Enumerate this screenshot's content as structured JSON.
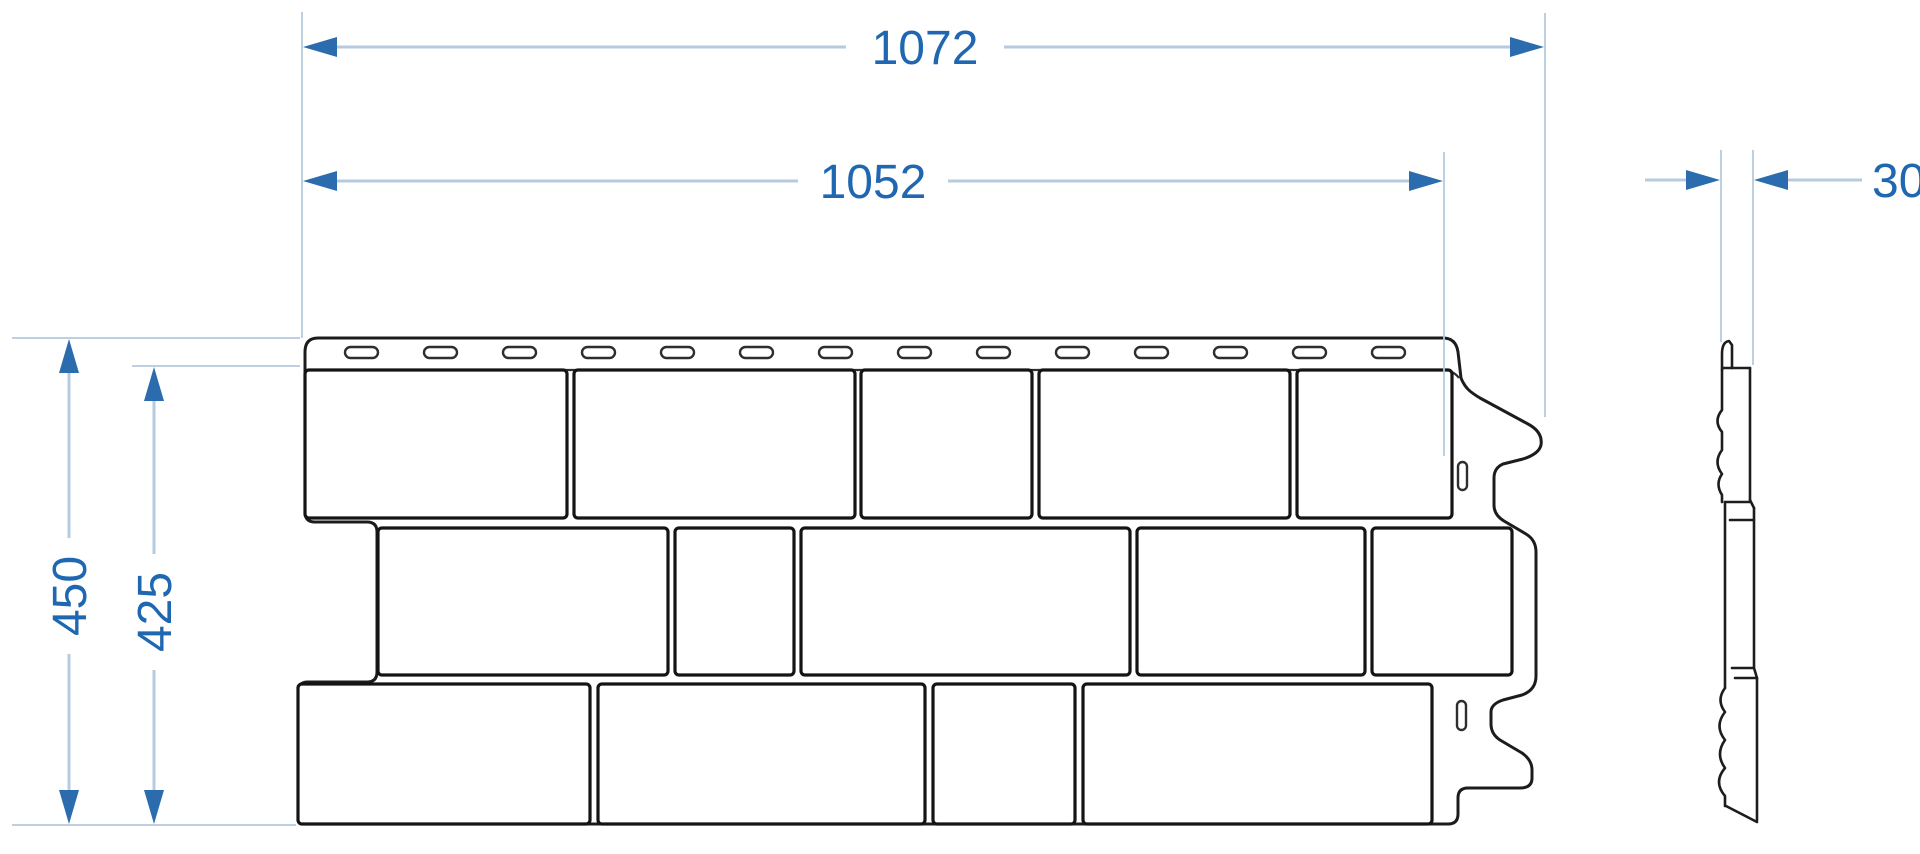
{
  "drawing": {
    "dimensions": {
      "outer_width": {
        "label": "1072"
      },
      "inner_width": {
        "label": "1052"
      },
      "outer_height": {
        "label": "450"
      },
      "inner_height": {
        "label": "425"
      },
      "thickness": {
        "label": "30"
      }
    },
    "colors": {
      "dim_line": "#b6cbdf",
      "dim_accent": "#2a6cad",
      "dim_text": "#1f67b0",
      "outline": "#1c1c1c",
      "fill": "#ffffff",
      "background": "#ffffff"
    },
    "nail_slots": {
      "count": 14,
      "start_x": 345,
      "spacing": 79,
      "y": 347,
      "width": 33,
      "height": 11
    },
    "drain_slots": [
      {
        "x": 1458,
        "y": 462,
        "w": 9,
        "h": 28
      },
      {
        "x": 1457,
        "y": 701,
        "w": 9,
        "h": 29
      }
    ],
    "brick_rows": [
      {
        "y": 370,
        "h": 148,
        "bricks": [
          [
            305,
            262
          ],
          [
            574,
            281
          ],
          [
            861,
            171
          ],
          [
            1039,
            251
          ],
          [
            1297,
            155
          ]
        ]
      },
      {
        "y": 528,
        "h": 147,
        "bricks": [
          [
            378,
            290
          ],
          [
            675,
            119
          ],
          [
            801,
            329
          ],
          [
            1137,
            228
          ],
          [
            1372,
            140
          ]
        ]
      },
      {
        "y": 684,
        "h": 140,
        "bricks": [
          [
            298,
            292
          ],
          [
            598,
            327
          ],
          [
            933,
            142
          ],
          [
            1083,
            349
          ]
        ]
      }
    ]
  }
}
